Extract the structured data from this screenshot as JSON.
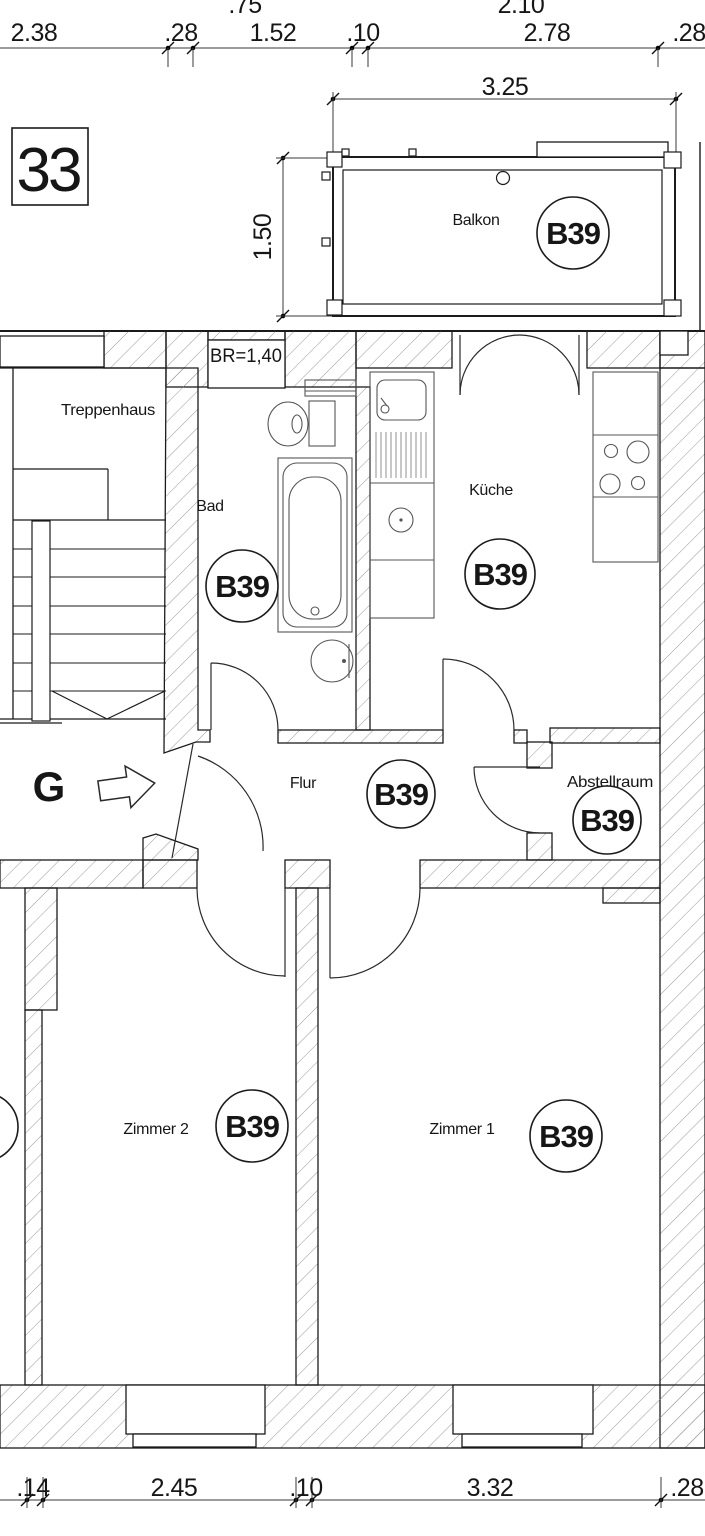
{
  "title_box": "33",
  "stair_marker": "G",
  "balcony_door_note": "BR=1,40",
  "unit_label": "B39",
  "rooms": {
    "balkon": {
      "name": "Balkon"
    },
    "treppenhaus": {
      "name": "Treppenhaus"
    },
    "bad": {
      "name": "Bad"
    },
    "kueche": {
      "name": "Küche"
    },
    "flur": {
      "name": "Flur"
    },
    "abstellraum": {
      "name": "Abstellraum"
    },
    "zimmer1": {
      "name": "Zimmer 1"
    },
    "zimmer2": {
      "name": "Zimmer 2"
    }
  },
  "dimensions": {
    "top_row_partial": [
      ".75",
      "2.10"
    ],
    "top_row": [
      "2.38",
      ".28",
      "1.52",
      ".10",
      "2.78",
      ".28"
    ],
    "balcony_width": "3.25",
    "balcony_depth": "1.50",
    "bottom_row": [
      ".14",
      "2.45",
      ".10",
      "3.32",
      ".28"
    ]
  }
}
